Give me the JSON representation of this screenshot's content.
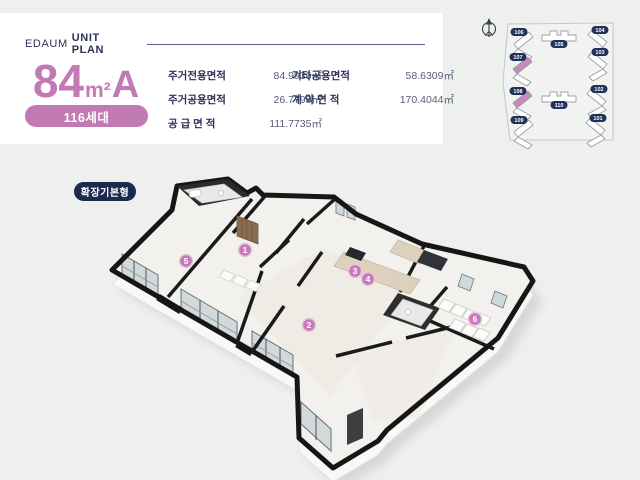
{
  "header": {
    "brand": "EDAUM",
    "title": "UNIT PLAN"
  },
  "unit": {
    "number": "84",
    "sqm": "m²",
    "letter": "A",
    "households": "116세대"
  },
  "areas": {
    "col1": [
      {
        "label": "주거전용면적",
        "value": "84.9936㎡"
      },
      {
        "label": "주거공용면적",
        "value": "26.7799㎡"
      },
      {
        "label": "공 급 면 적",
        "value": "111.7735㎡"
      }
    ],
    "col2": [
      {
        "label": "기타공용면적",
        "value": "58.6309㎡"
      },
      {
        "label": "계 약 면 적",
        "value": "170.4044㎡"
      }
    ]
  },
  "plan_tag": {
    "label": "확장기본형"
  },
  "floor_plan": {
    "markers": [
      {
        "n": "1",
        "x": 245,
        "y": 250
      },
      {
        "n": "2",
        "x": 309,
        "y": 325
      },
      {
        "n": "3",
        "x": 355,
        "y": 271
      },
      {
        "n": "4",
        "x": 368,
        "y": 279
      },
      {
        "n": "5",
        "x": 186,
        "y": 261
      },
      {
        "n": "6",
        "x": 475,
        "y": 319
      }
    ]
  },
  "site_map": {
    "compass": "north-compass",
    "buildings": [
      {
        "id": "106",
        "x": 524,
        "y": 41,
        "type": "chevron",
        "mirror": false,
        "highlight": false
      },
      {
        "id": "105",
        "x": 559,
        "y": 36,
        "type": "strip",
        "mirror": false,
        "highlight": false
      },
      {
        "id": "104",
        "x": 597,
        "y": 39,
        "type": "chevron",
        "mirror": true,
        "highlight": false
      },
      {
        "id": "107",
        "x": 523,
        "y": 66,
        "type": "chevron",
        "mirror": false,
        "highlight": true
      },
      {
        "id": "103",
        "x": 597,
        "y": 61,
        "type": "chevron",
        "mirror": true,
        "highlight": false
      },
      {
        "id": "108",
        "x": 523,
        "y": 100,
        "type": "chevron",
        "mirror": false,
        "highlight": true
      },
      {
        "id": "110",
        "x": 559,
        "y": 97,
        "type": "strip",
        "mirror": false,
        "highlight": false
      },
      {
        "id": "102",
        "x": 596,
        "y": 98,
        "type": "chevron",
        "mirror": true,
        "highlight": false
      },
      {
        "id": "109",
        "x": 524,
        "y": 129,
        "type": "chevron",
        "mirror": false,
        "highlight": false
      },
      {
        "id": "101",
        "x": 595,
        "y": 127,
        "type": "chevron",
        "mirror": true,
        "highlight": false
      }
    ]
  },
  "colors": {
    "accent_pink": "#c17ab4",
    "marker_pink": "#c979ba",
    "navy": "#2b3158",
    "badge_navy": "#1c2a4d",
    "wall_black": "#161616"
  }
}
